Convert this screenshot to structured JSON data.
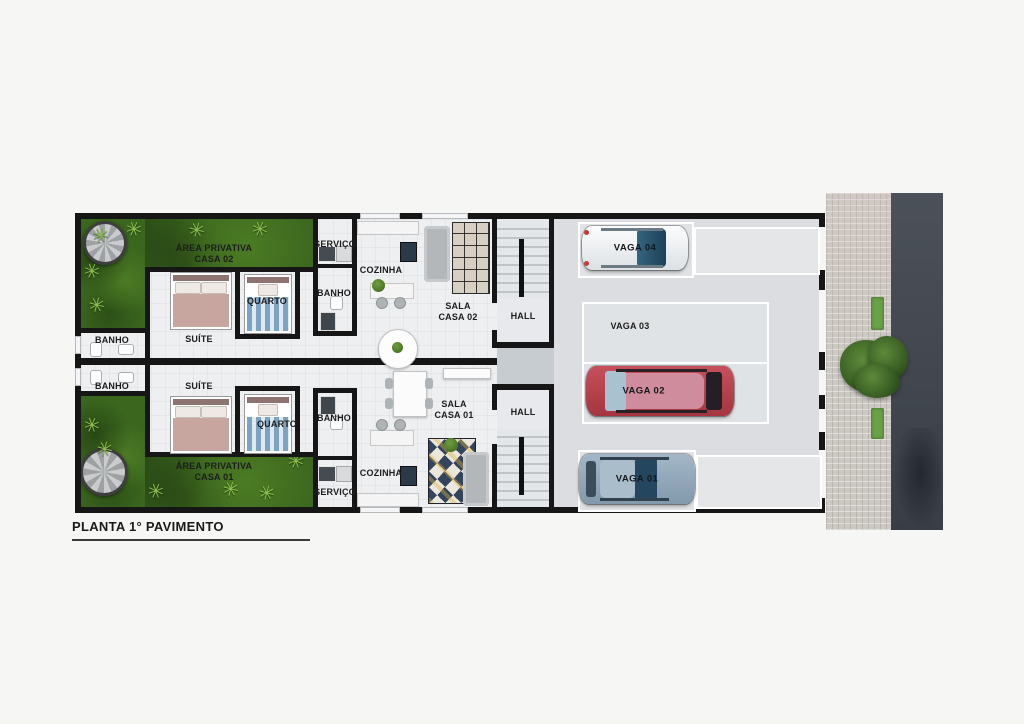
{
  "title": "PLANTA 1° PAVIMENTO",
  "plan": {
    "casa02": {
      "area_line1": "ÁREA PRIVATIVA",
      "area_line2": "CASA 02",
      "servico": "SERVIÇO",
      "cozinha": "COZINHA",
      "banho_left": "BANHO",
      "banho_right": "BANHO",
      "quarto": "QUARTO",
      "suite": "SUÍTE",
      "sala_line1": "SALA",
      "sala_line2": "CASA 02",
      "hall": "HALL"
    },
    "casa01": {
      "area_line1": "ÁREA PRIVATIVA",
      "area_line2": "CASA 01",
      "servico": "SERVIÇO",
      "cozinha": "COZINHA",
      "banho_left": "BANHO",
      "banho_right": "BANHO",
      "quarto": "QUARTO",
      "suite": "SUÍTE",
      "sala_line1": "SALA",
      "sala_line2": "CASA 01",
      "hall": "HALL"
    },
    "garagem": {
      "vaga01": "VAGA 01",
      "vaga02": "VAGA 02",
      "vaga03": "VAGA 03",
      "vaga04": "VAGA 04"
    }
  },
  "icons": {
    "palm_tree": "✳"
  },
  "colors": {
    "wall": "#161616",
    "garden_green": "#3a661e",
    "floor": "#edeff0",
    "garage_floor": "#dbdde0",
    "sidewalk": "#ccc8c2",
    "street": "#42474f",
    "car_vaga04_body": "#f2f4f5",
    "car_vaga02_body": "#bf4a55",
    "car_vaga01_body": "#97aec2"
  }
}
